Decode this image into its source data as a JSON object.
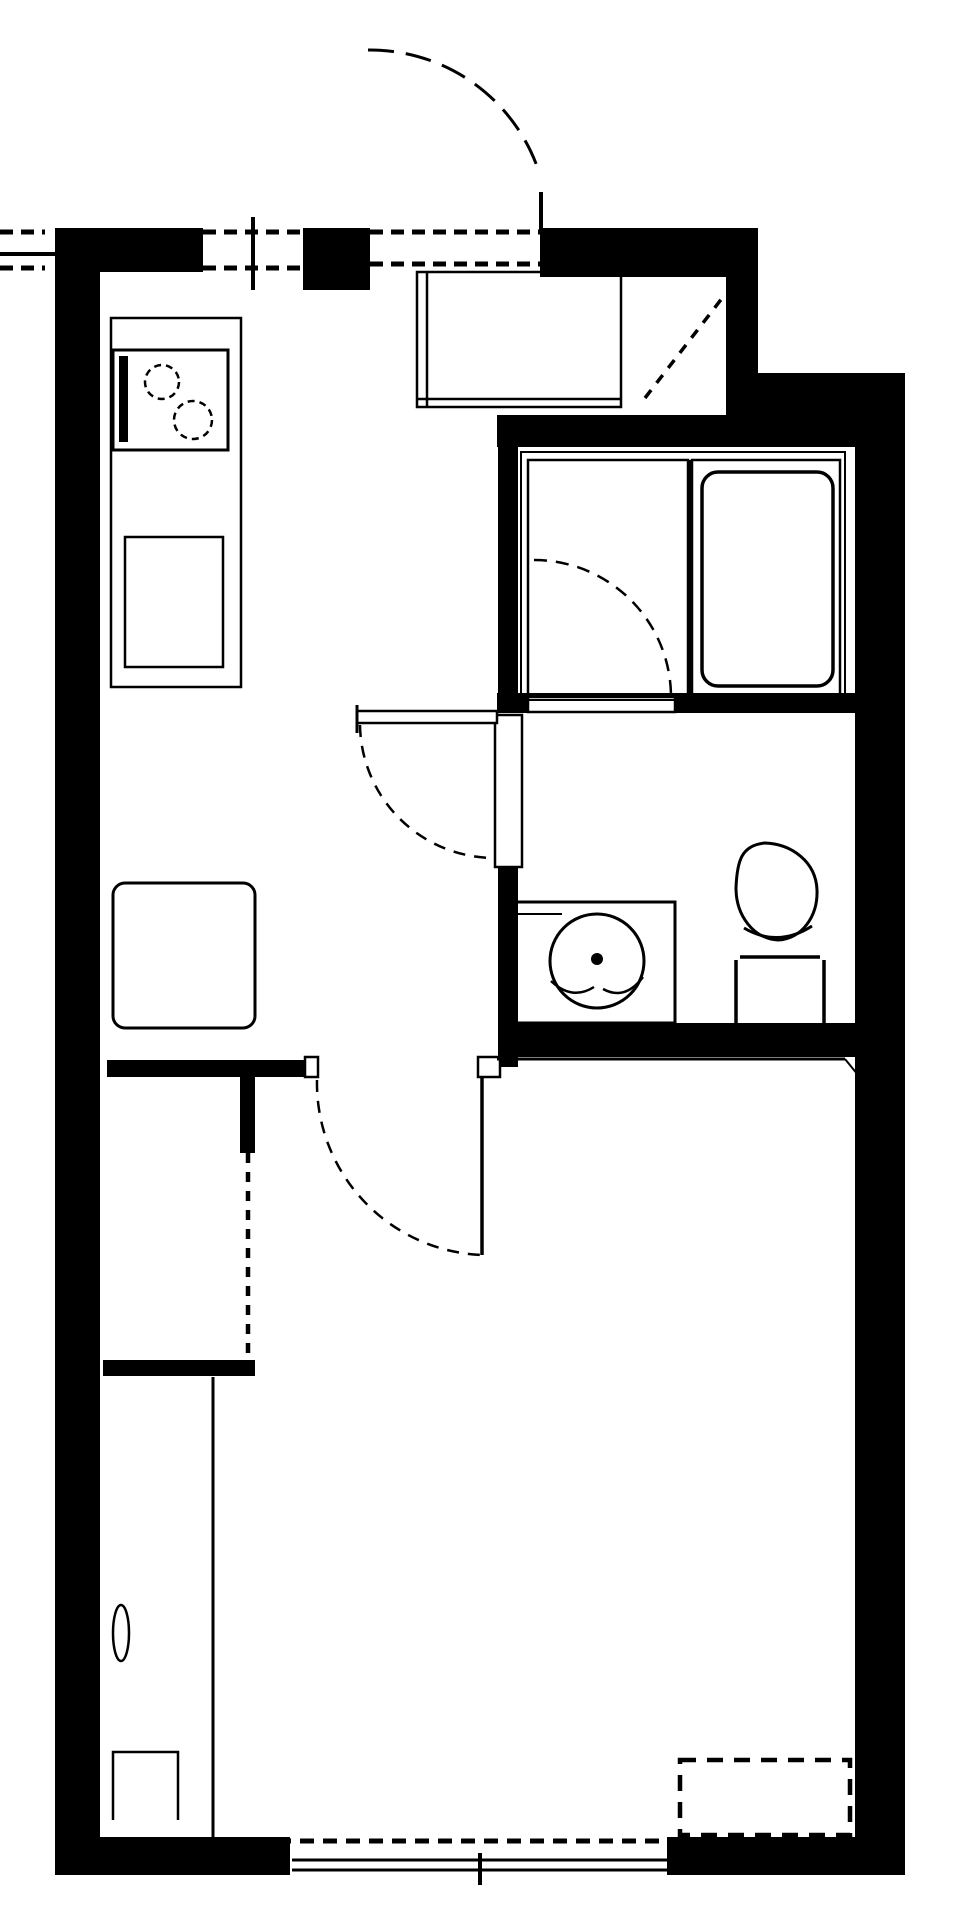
{
  "plan": {
    "kind": "apartment-floor-plan",
    "background_color": "#ffffff",
    "wall_color": "#000000",
    "canvas": {
      "width": 960,
      "height": 1920
    },
    "rooms": [
      {
        "name": "entry-genkan"
      },
      {
        "name": "kitchen-hall"
      },
      {
        "name": "bathroom"
      },
      {
        "name": "washroom-toilet"
      },
      {
        "name": "closet"
      },
      {
        "name": "bedroom"
      }
    ],
    "fixtures": [
      "entrance-swing-door",
      "kitchen-window",
      "shoe-cabinet",
      "entry-step-diagonal",
      "kitchen-counter",
      "two-burner-stove",
      "kitchen-sink",
      "refrigerator",
      "hall-swing-door",
      "washroom-door-opening",
      "unit-bath",
      "bathtub",
      "bath-swing-door",
      "washing-machine-pan",
      "toilet",
      "bedroom-swing-door",
      "closet-dashed-front",
      "side-strip-handle",
      "side-strip-niche",
      "aircon-dashed-box",
      "bedroom-window"
    ]
  }
}
